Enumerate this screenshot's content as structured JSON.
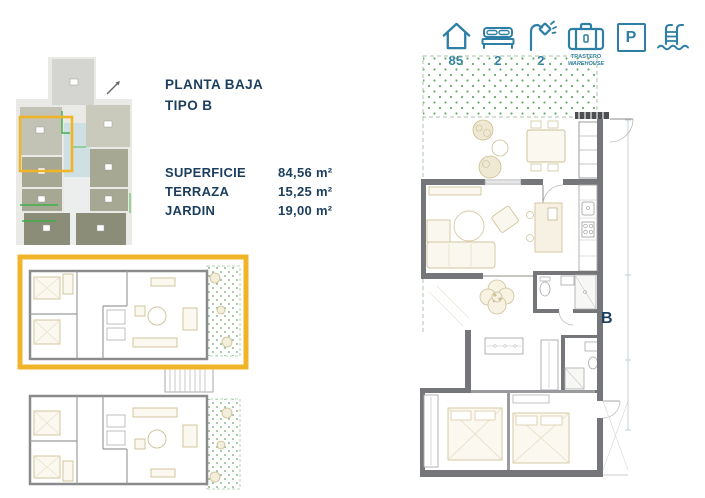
{
  "colors": {
    "navy": "#1c3e5e",
    "teal": "#2e7fa6",
    "highlight_yellow": "#F0B428",
    "wall_gray": "#75767a",
    "furniture_tan": "#d2c49c",
    "garden_green": "#6aa86e"
  },
  "header_icons": {
    "area": {
      "icon": "house-icon",
      "value": "85"
    },
    "bedrooms": {
      "icon": "bed-icon",
      "value": "2"
    },
    "bathrooms": {
      "icon": "shower-icon",
      "value": "2"
    },
    "storage": {
      "icon": "trunk-icon",
      "label_top": "TRASTERO",
      "label_bottom": "WAREHOUSE"
    },
    "parking": {
      "icon": "parking-icon",
      "letter": "P"
    },
    "pool": {
      "icon": "pool-ladder-icon"
    }
  },
  "info": {
    "title_line1": "PLANTA BAJA",
    "title_line2": "TIPO B",
    "areas": [
      {
        "label": "SUPERFICIE",
        "value": "84,56 m²"
      },
      {
        "label": "TERRAZA",
        "value": "15,25 m²"
      },
      {
        "label": "JARDIN",
        "value": "19,00 m²"
      }
    ]
  },
  "detail_plan": {
    "unit_label": "B"
  }
}
